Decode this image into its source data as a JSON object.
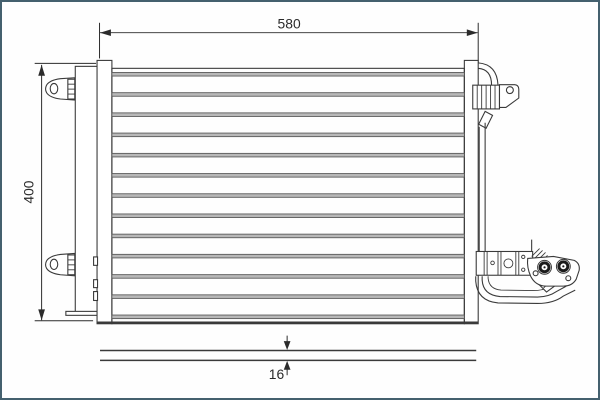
{
  "drawing": {
    "title": "condenser-technical-drawing",
    "dimensions": {
      "width_label": "580",
      "height_label": "400",
      "depth_label": "16"
    },
    "core": {
      "tube_count": 13
    },
    "colors": {
      "frame": "#44606e",
      "background": "#fefefe",
      "line": "#3a3a3a",
      "ink": "#2b2b2b",
      "tube_fill": "#b8b8b8",
      "tube_edge": "#5a5a5a",
      "port_ring": "#1b1b1b"
    }
  }
}
